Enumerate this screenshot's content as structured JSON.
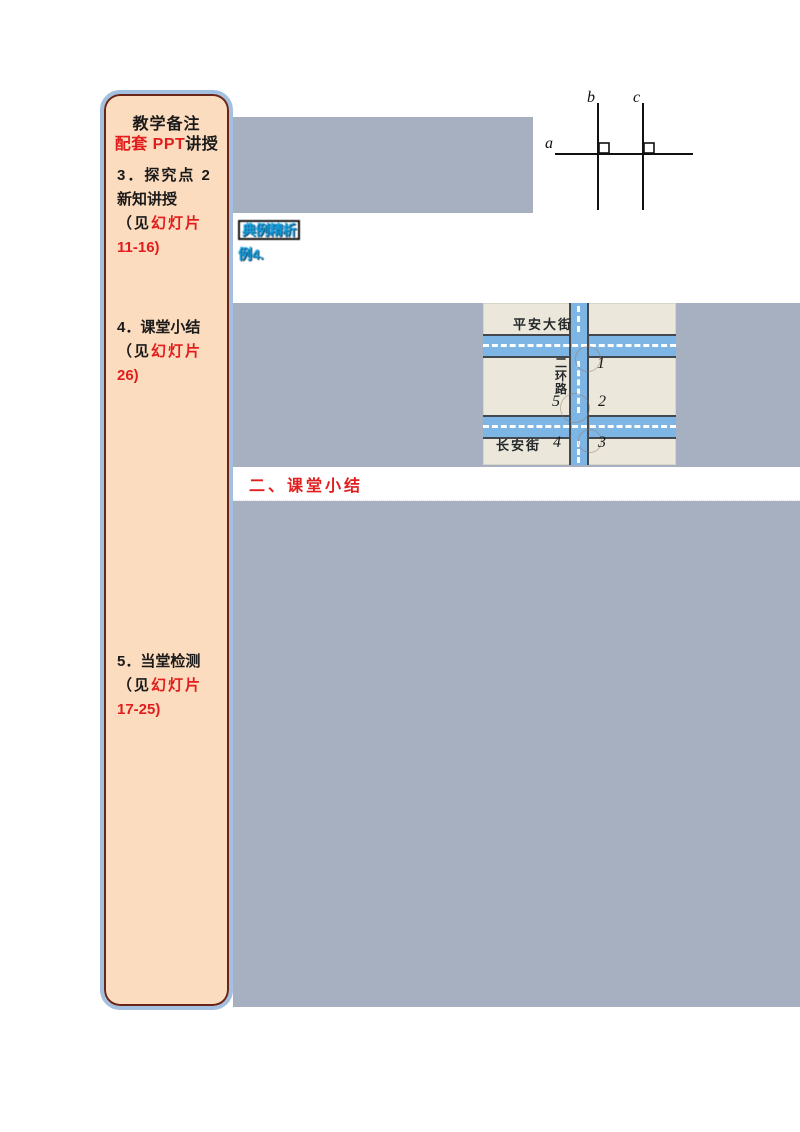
{
  "sidebar": {
    "header": "教学备注",
    "subheader_red": "配套 PPT",
    "subheader_black": "讲授",
    "items": [
      {
        "num": "3．",
        "title": "探究点 2",
        "title2": "新知讲授",
        "see_black": "（见",
        "see_red": "幻灯片",
        "pages": "11-16)"
      },
      {
        "num": "4．",
        "title": "课堂小结",
        "see_black": "（见",
        "see_red": "幻灯片",
        "pages": "26)"
      },
      {
        "num": "5．",
        "title": "当堂检测",
        "see_black": "（见",
        "see_red": "幻灯片",
        "pages": "17-25)"
      }
    ]
  },
  "geometry_diagram": {
    "label_a": "a",
    "label_b": "b",
    "label_c": "c"
  },
  "annotation": {
    "line1": "典例精析",
    "line2": "例4."
  },
  "street_map": {
    "street_top": "平安大街",
    "street_vertical": "二环路",
    "street_bottom": "长安街",
    "angles": {
      "n1": "1",
      "n2": "2",
      "n3": "3",
      "n4": "4",
      "n5": "5"
    }
  },
  "summary": {
    "heading": "二、课堂小结"
  },
  "colors": {
    "sidebar_bg": "#fcdcbe",
    "sidebar_border": "#a3c0e0",
    "sidebar_inner_border": "#6b2418",
    "main_shade": "#a6b0c1",
    "accent_red": "#e11d1d",
    "annotation_blue": "#14a3e8",
    "road_blue": "#7db6e4",
    "map_bg": "#ebe8db"
  }
}
